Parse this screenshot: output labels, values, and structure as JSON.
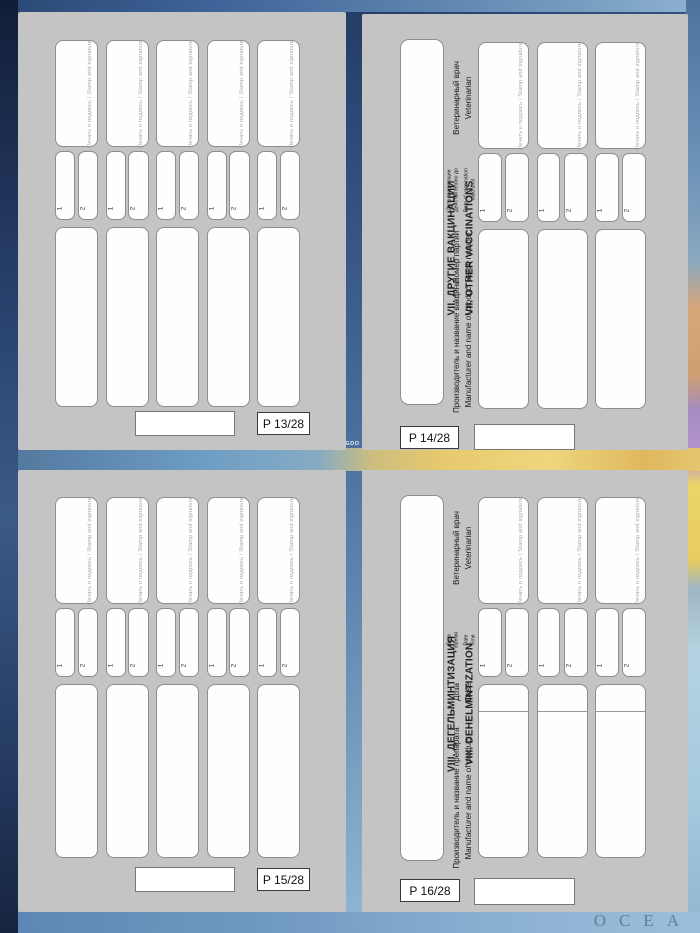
{
  "labels": {
    "stamp_watermark": "Печать и подпись / Stamp and signature",
    "field1": "1",
    "field2": "2"
  },
  "pages": {
    "p13": {
      "number": "P 13/28",
      "record_count": "5"
    },
    "p14": {
      "number": "P 14/28",
      "record_count": "3",
      "title_ru": "VII. ДРУГИЕ ВАКЦИНАЦИИ",
      "title_en": "VII. OTHER VACCINATIONS",
      "col_manufacturer_ru": "Производитель и название вакцины",
      "col_manufacturer_en": "Manufacturer and name of product",
      "col_batch_ru": "Номер партии",
      "col_batch_en": "Batch number",
      "col_date_ru1": "Дата вакцинации",
      "col_date_ru2": "Действительно до",
      "col_date_en1": "Date of vaccination",
      "col_date_en2": "Valid until",
      "col_vet_ru": "Ветеринарный врач",
      "col_vet_en": "Veterinarian"
    },
    "p15": {
      "number": "P 15/28",
      "record_count": "5"
    },
    "p16": {
      "number": "P 16/28",
      "record_count": "3",
      "title_ru": "VIII. ДЕГЕЛЬМИНТИЗАЦИЯ",
      "title_en": "VIII. DEHELMINTIZATION",
      "col_manufacturer_ru": "Производитель и название препарата",
      "col_manufacturer_en": "Manufacturer and name of product",
      "col_dose_ru": "Доза",
      "col_dose_en": "Dose",
      "col_date_ru1": "Дата",
      "col_date_ru2": "Время",
      "col_date_en1": "Date",
      "col_date_en2": "Time",
      "col_vet_ru": "Ветеринарный врач",
      "col_vet_en": "Veterinarian"
    }
  },
  "background": {
    "ocean_label": "OCEA",
    "map_fragment_label": "NGDO"
  }
}
